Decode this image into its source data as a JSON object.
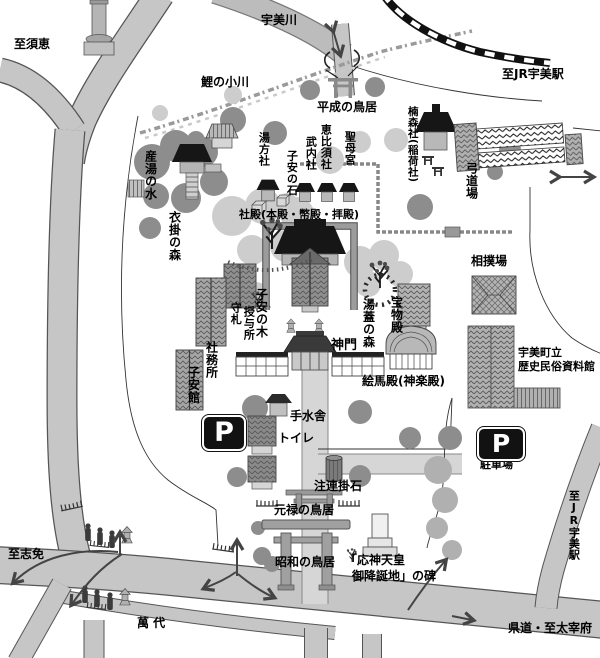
{
  "map_type": "shrine-grounds-guide-map",
  "colors": {
    "road": "#c6c6c6",
    "river": "#bcbcbc",
    "rail": "#111111",
    "tree_dark": "#8d8d8d",
    "foliage": "#cdcdcd",
    "roof_black": "#161616",
    "building_gray": "#a6a6a6",
    "approach_path": "#d6d6d6",
    "outline": "#444444"
  },
  "labels": {
    "to_sue": "至須恵",
    "umi_river": "宇美川",
    "to_jr_umi_top": "至JR宇美駅",
    "koi_no_ogawa": "鯉の小川",
    "heisei_no_torii": "平成の鳥居",
    "kusumori_sha": "楠森社(稲荷社)",
    "kyudojo": "弓道場",
    "sumo_ba": "相撲場",
    "museum_l1": "宇美町立",
    "museum_l2": "歴史民俗資料館",
    "ubuyu_no_mizu": "産湯の水",
    "kinukake_no_mori": "衣掛の森",
    "yumokata_sha": "湯方社",
    "koyasu_no_ishi": "子安の石",
    "takeuchi_sha": "武内社",
    "ebisu_sha": "恵比須社",
    "seibo_gu": "聖母宮",
    "shaden": "社殿(本殿・幣殿・拝殿)",
    "mamorifuda_l1": "守札",
    "mamorifuda_l2": "授与所",
    "koyasu_no_ki": "子安の木",
    "shamusho": "社務所",
    "koyasu_kan": "子安館",
    "yubuta_no_mori": "湯蓋の森",
    "homotsuden": "宝物殿",
    "shinmon": "神門",
    "emaden": "絵馬殿(神楽殿)",
    "temizusha": "手水舎",
    "toire": "トイレ",
    "shimekake_ishi": "注連掛石",
    "genroku_no_torii": "元禄の鳥居",
    "showa_no_torii": "昭和の鳥居",
    "ojin_l1": "「応神天皇",
    "ojin_l2": "御降誕地」の碑",
    "chushajo": "駐車場",
    "p_glyph": "P",
    "to_shime": "至志免",
    "mandai": "萬 代",
    "to_jr_umi_right": "至JR宇美駅",
    "kendo_dazaifu": "県道・至太宰府"
  },
  "icons": {
    "parking_sign": "P-in-rounded-black-square",
    "railway": "black-white-dashed-band",
    "torii": "gray-gate-symbol",
    "two_way_arrow": "double-headed-arrow",
    "flow_arrow": "curved-arrow-with-chevron"
  }
}
